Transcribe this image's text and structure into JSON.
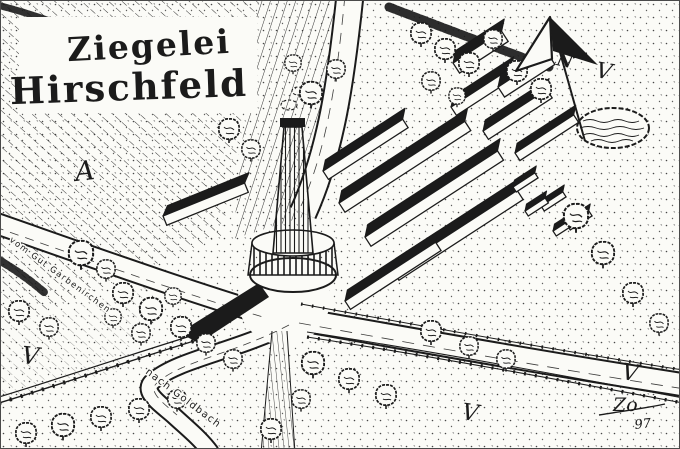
{
  "artwork": {
    "title": {
      "line1": "Ziegelei",
      "line2": "Hirschfeld"
    },
    "compass": {
      "north_label": "N"
    },
    "road_labels": {
      "from": "vom Gut Garbenirchen",
      "to": "nach Goldbach"
    },
    "field_marks": [
      {
        "glyph": "A"
      },
      {
        "glyph": "V"
      },
      {
        "glyph": "V"
      },
      {
        "glyph": "V"
      },
      {
        "glyph": "V"
      }
    ],
    "signature": {
      "initials": "Zo",
      "year": "97"
    },
    "colors": {
      "ink": "#1b1b1b",
      "paper": "#fbfbf7"
    }
  }
}
